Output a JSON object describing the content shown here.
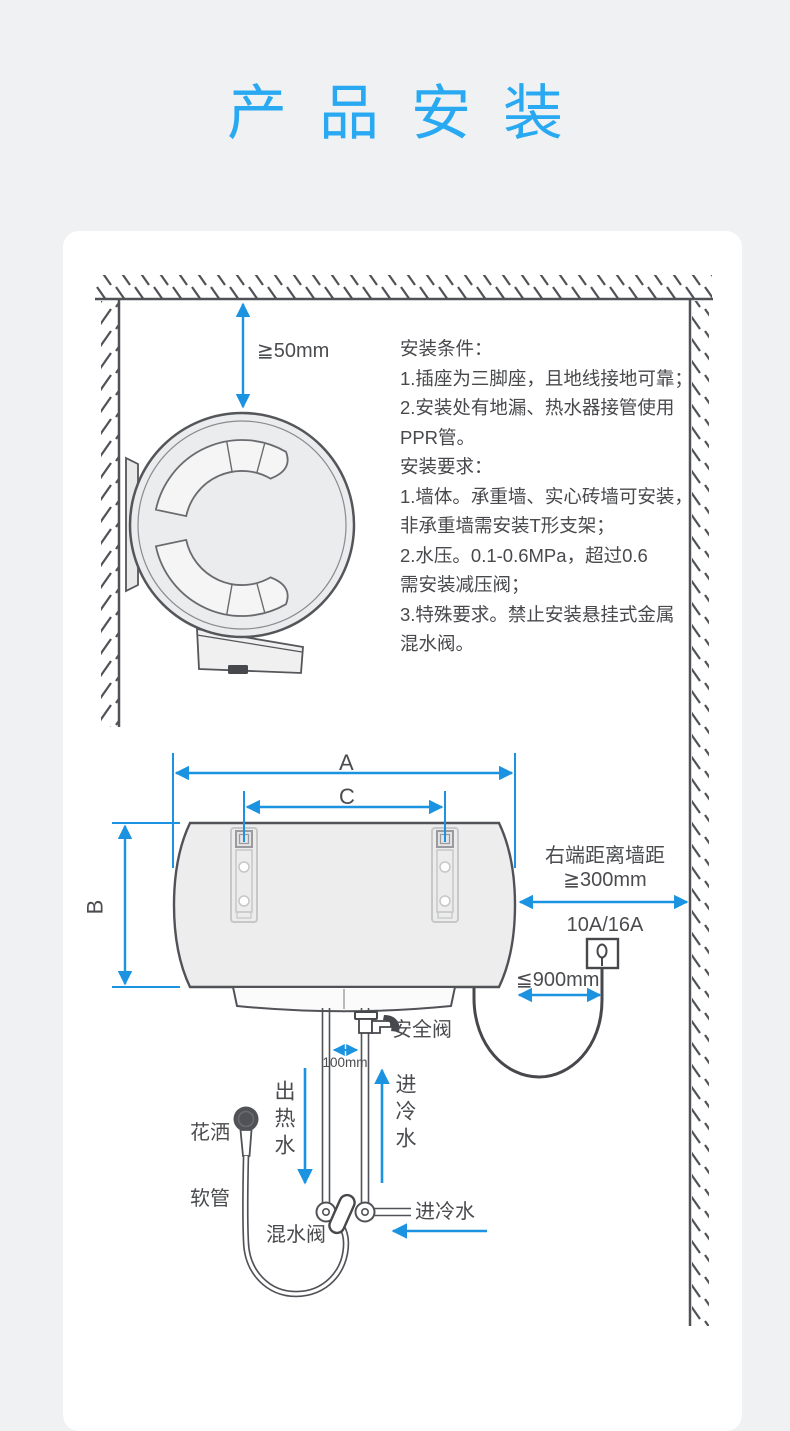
{
  "page": {
    "title": "产品安装",
    "colors": {
      "title_blue": "#28a9f2",
      "dimension_blue": "#1b93e0",
      "line_gray": "#515257",
      "text_gray": "#4b4c4f",
      "card_bg": "#ffffff",
      "page_bg": "#f0f1f2"
    }
  },
  "side_view": {
    "ceiling_gap": "≧50mm",
    "conditions": "安装条件：\n1.插座为三脚座，且地线接地可靠；\n2.安装处有地漏、热水器接管使用\nPPR管。\n安装要求：\n1.墙体。承重墙、实心砖墙可安装，\n非承重墙需安装T形支架；\n2.水压。0.1-0.6MPa，超过0.6\n需安装减压阀；\n3.特殊要求。禁止安装悬挂式金属\n混水阀。"
  },
  "front_view": {
    "dim_a": "A",
    "dim_b": "B",
    "dim_c": "C",
    "wall_distance_line1": "右端距离墙距",
    "wall_distance_line2": "≧300mm",
    "socket_rating": "10A/16A",
    "socket_max_height": "≦900mm",
    "pipe_gap": "100mm",
    "safety_valve": "安全阀",
    "hot_water_out": "出热水",
    "cold_water_in": "进冷水",
    "shower_head": "花洒",
    "hose": "软管",
    "mixer_valve": "混水阀",
    "cold_inlet": "进冷水"
  }
}
